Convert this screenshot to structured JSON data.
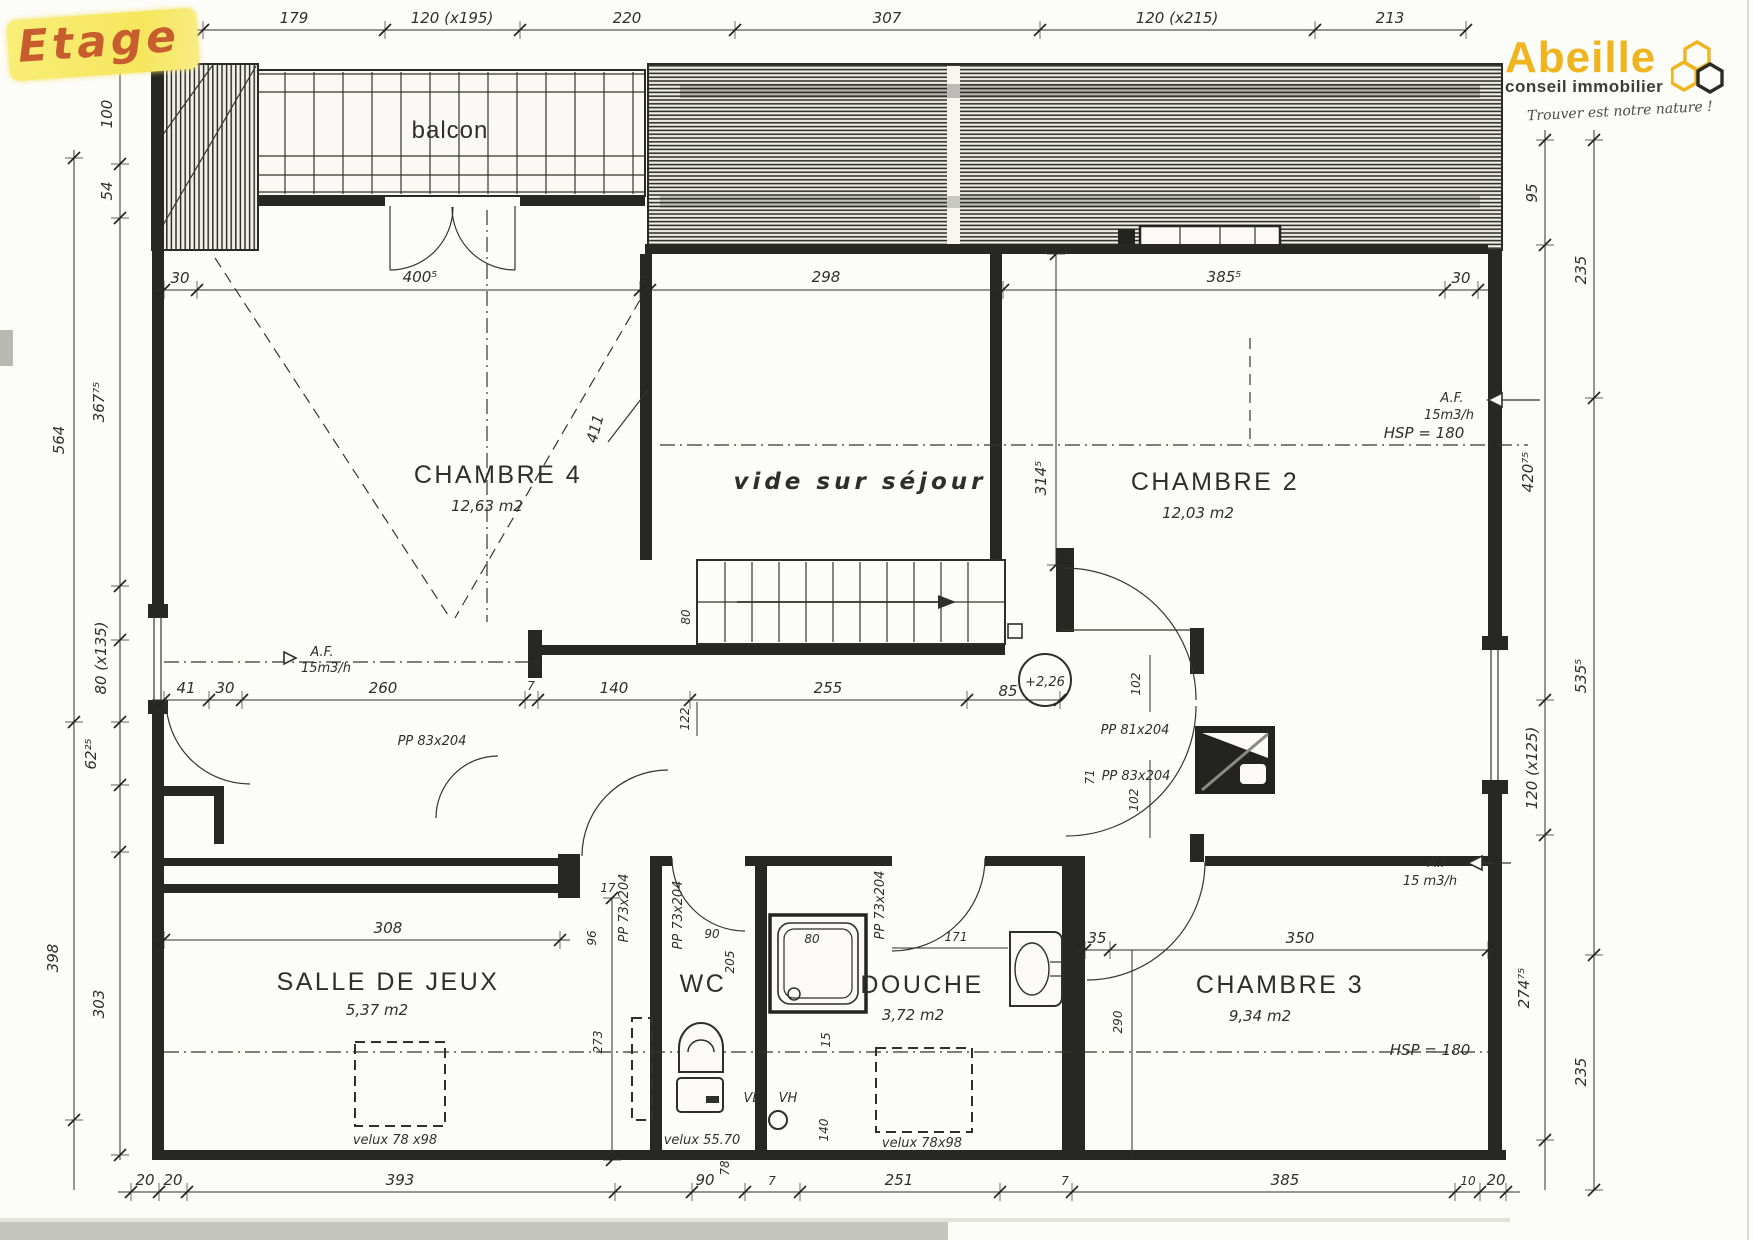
{
  "annotation": {
    "etage": "Etage"
  },
  "logo": {
    "brand": "Abeille",
    "subtitle": "conseil immobilier",
    "tagline": "Trouver est notre nature !",
    "brand_color": "#f0b41e"
  },
  "rooms": {
    "balcon": {
      "name": "balcon"
    },
    "chambre4": {
      "name": "CHAMBRE 4",
      "area": "12,63 m2"
    },
    "vide": {
      "name": "vide sur séjour"
    },
    "chambre2": {
      "name": "CHAMBRE 2",
      "area": "12,03 m2"
    },
    "salle_de_jeux": {
      "name": "SALLE DE JEUX",
      "area": "5,37 m2"
    },
    "wc": {
      "name": "WC"
    },
    "douche": {
      "name": "DOUCHE",
      "area": "3,72 m2"
    },
    "chambre3": {
      "name": "CHAMBRE 3",
      "area": "9,34 m2"
    }
  },
  "annotations": {
    "level_mark": "+2,26",
    "hsp_ch2": "HSP = 180",
    "hsp_ch3": "HSP = 180",
    "af1": "A.F.",
    "af1_flow": "15m3/h",
    "af2": "A.F.",
    "af2_flow": "15m3/h",
    "af3": "A.F",
    "af3_flow": "15 m3/h",
    "velux_salle": "velux 78 x98",
    "velux_wc": "velux 55.70",
    "velux_douche": "velux 78x98",
    "ve": "VE",
    "vh": "VH"
  },
  "doors": {
    "pp83_left": "PP 83x204",
    "pp81": "PP 81x204",
    "pp83_right": "PP 83x204",
    "pp73_a": "PP 73x204",
    "pp73_b": "PP 73x204",
    "pp73_c": "PP 73x204"
  },
  "dims": {
    "top": [
      "41",
      "179",
      "120 (x195)",
      "220",
      "307",
      "120 (x215)",
      "213"
    ],
    "upper_row": [
      "30",
      "400⁵",
      "7",
      "298",
      "385⁵",
      "30"
    ],
    "mid_row": [
      "41",
      "30",
      "260",
      "7",
      "140",
      "255",
      "85"
    ],
    "bottom_row": [
      "20",
      "20",
      "393",
      "90",
      "7",
      "251",
      "7",
      "385",
      "10",
      "20"
    ],
    "left_inner": [
      "100",
      "54",
      "367⁷⁵",
      "80 (x135)",
      "62²⁵",
      "303"
    ],
    "left_outer": [
      "564",
      "398"
    ],
    "right_inner": [
      "95",
      "420⁷⁵",
      "120 (x125)",
      "274⁷⁵"
    ],
    "right_outer": [
      "235",
      "535⁵",
      "235"
    ],
    "interior": {
      "d411": "411",
      "d314": "314⁵",
      "d80": "80",
      "d122": "122",
      "d102a": "102",
      "d102b": "102",
      "d71": "71",
      "d308": "308",
      "d96": "96",
      "d273": "273",
      "d205": "205",
      "d90": "90",
      "d17": "17",
      "d171": "171",
      "d35": "35",
      "d350": "350",
      "d290": "290",
      "d140": "140",
      "d15": "15",
      "d78": "78",
      "shower80": "80"
    }
  }
}
